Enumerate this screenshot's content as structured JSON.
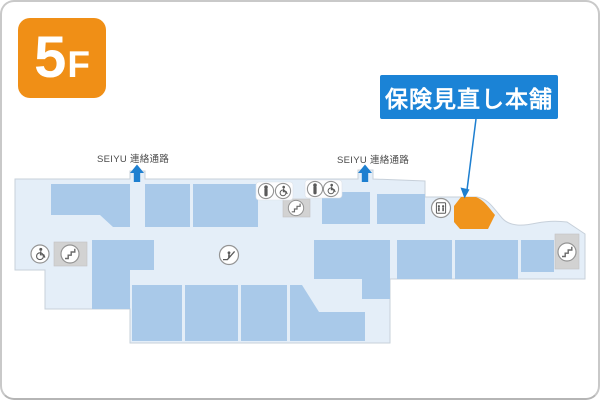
{
  "floor_badge": {
    "number": "5",
    "suffix": "F"
  },
  "callout": {
    "store_name": "保険見直し本舗"
  },
  "passages": {
    "left_label": "SEIYU 連絡通路",
    "right_label": "SEIYU 連絡通路"
  },
  "icons": [
    "accessible-icon",
    "stairs-icon",
    "escalator-icon",
    "toilet-icon",
    "accessible-toilet-icon",
    "stairs-icon",
    "toilet-icon",
    "accessible-toilet-icon",
    "elevator-icon",
    "stairs-icon",
    "up-arrow-icon",
    "up-arrow-icon"
  ],
  "colors": {
    "badge_orange": "#f08f16",
    "highlight_orange": "#f0941c",
    "callout_blue": "#1b83d6",
    "arrow_blue": "#1d7fd0",
    "floor_fill": "#e4eef8",
    "store_fill": "#a9c9e9",
    "utility_gray": "#d2d2d2",
    "label_gray": "#4a4a4a"
  }
}
